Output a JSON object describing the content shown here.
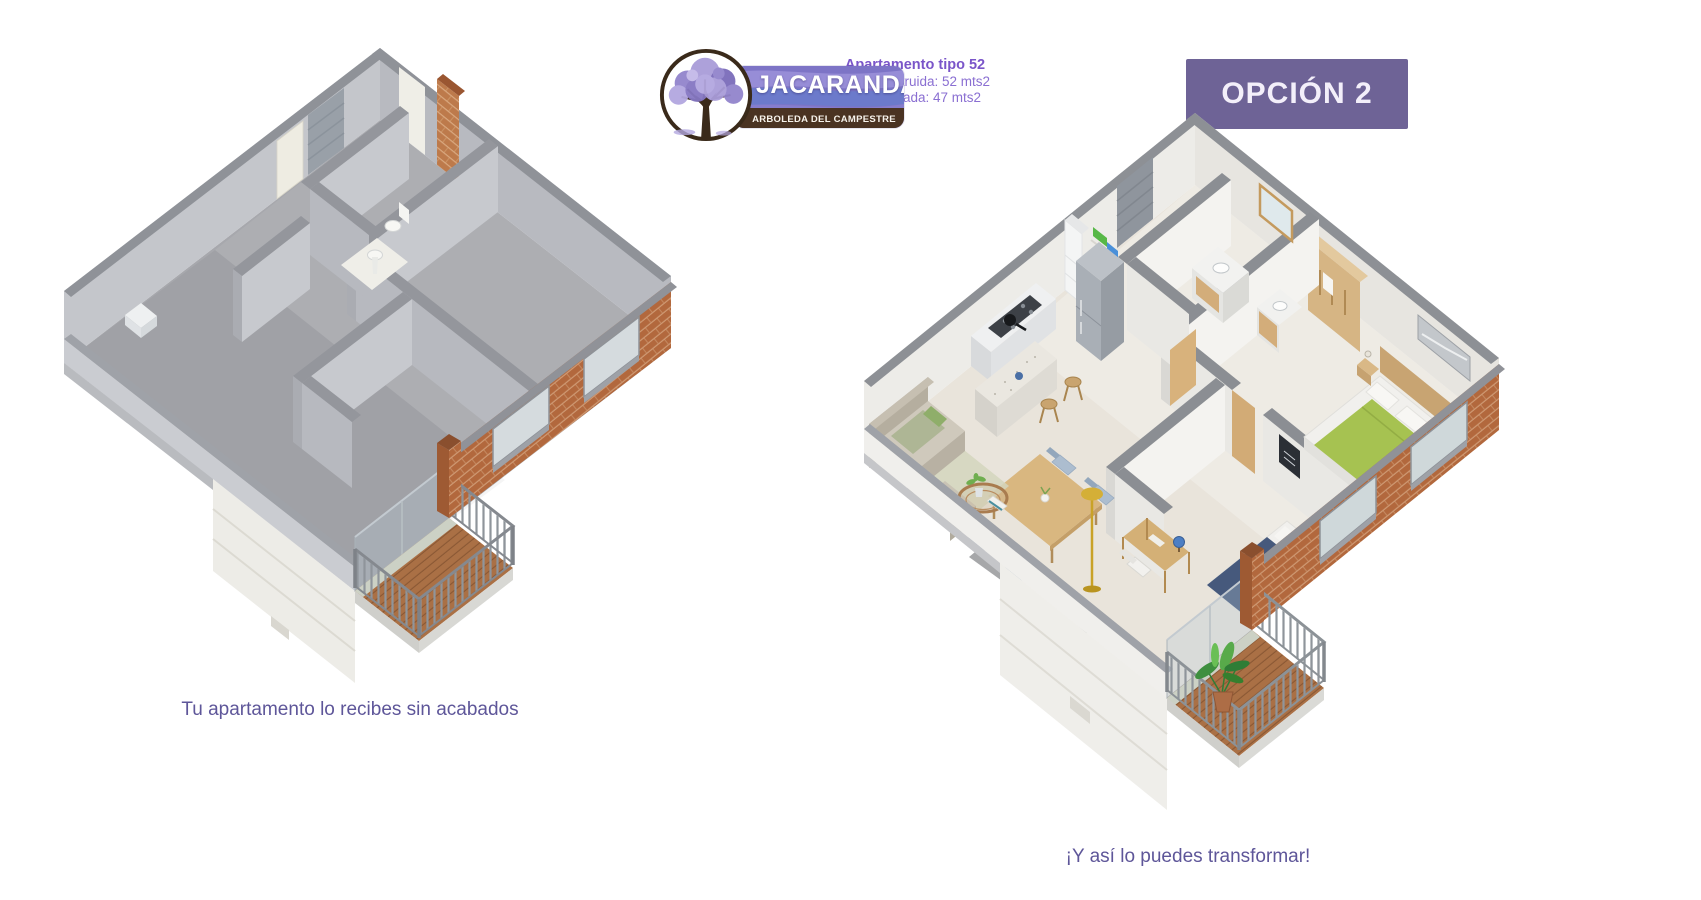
{
  "header": {
    "logo": {
      "icon": "jacaranda-tree-icon",
      "brand": "JACARANDA",
      "tagline": "ARBOLEDA DEL CAMPESTRE"
    },
    "info": {
      "title": "Apartamento tipo 52",
      "area_built": "Área construida: 52 mts2",
      "area_private": "Área privada: 47 mts2"
    },
    "option_button": {
      "label": "OPCIÓN 2"
    }
  },
  "panels": {
    "left": {
      "caption": "Tu apartamento lo recibes sin acabados",
      "render": "unfinished-concrete-apartment-3d-floorplan"
    },
    "right": {
      "caption": "¡Y así lo puedes transformar!",
      "render": "furnished-apartment-3d-floorplan"
    }
  },
  "colors": {
    "accent_button_purple": "#6e6396",
    "title_purple": "#7a55c9",
    "info_purple": "#8a6fd2",
    "caption_purple": "#5e5699",
    "banner_purple": "#7d74c6",
    "banner_brown": "#4a3322",
    "tree_foliage_purple": "#9284cc",
    "brick_terracotta": "#b2683d",
    "concrete_grey": "#a7a8ad",
    "facade_cream": "#edece7",
    "wood_deck_brown": "#aa7045",
    "furniture_wood": "#d4b076",
    "bed_green": "#a6c251",
    "bed_navy": "#46597c",
    "plant_green": "#3f8f3f"
  }
}
